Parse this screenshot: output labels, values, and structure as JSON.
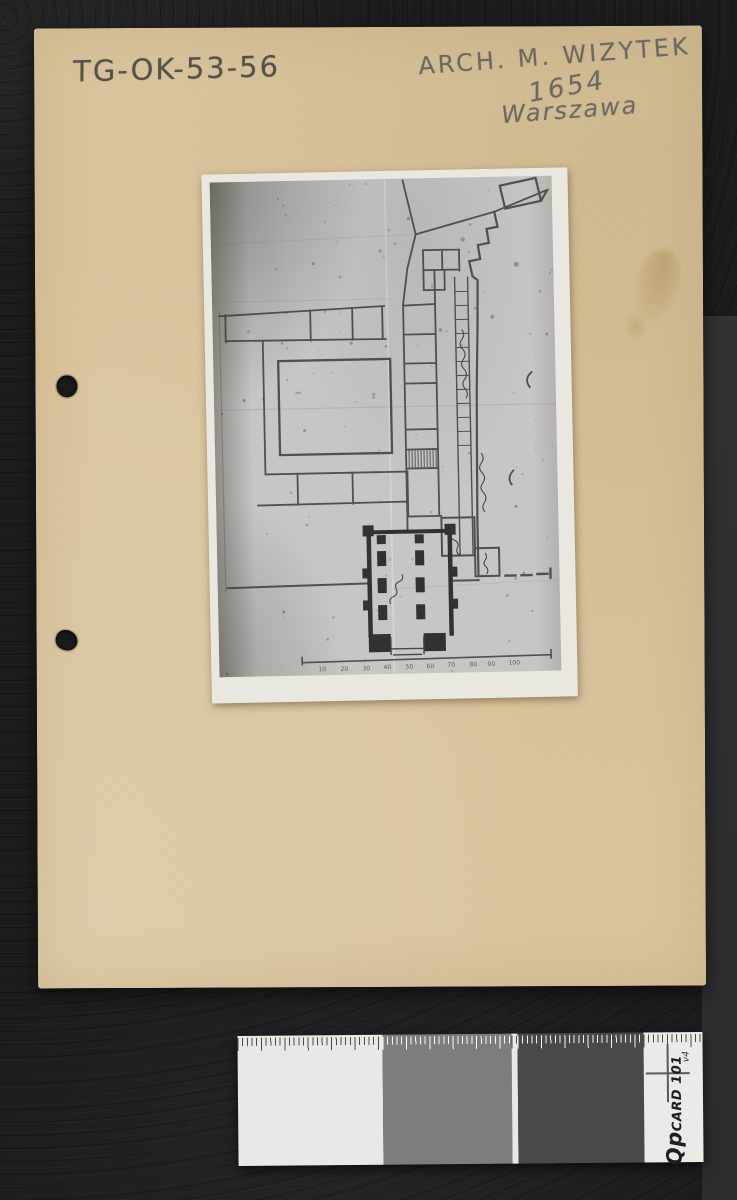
{
  "card": {
    "catalog_number": "TG-OK-53-56",
    "inscription_line1": "ARCH. M. WIZYTEK",
    "inscription_line2": "1654",
    "inscription_line3": "Warszawa"
  },
  "photo": {
    "scale_labels": [
      "10",
      "20",
      "30",
      "40",
      "50",
      "60",
      "70",
      "80",
      "90",
      "100"
    ]
  },
  "qpcard": {
    "brand_prefix": "Qp",
    "brand_rest": "CARD 101",
    "version": "v4",
    "patch_colors": {
      "white": "#e9e8e3",
      "gray": "#7d7d7b",
      "dark": "#4a4947"
    }
  },
  "colors": {
    "background_leather": "#1c1c1e",
    "background_band": "#302f31",
    "card_beige": "#d8c39c",
    "photo_paper": "#c7c6c1",
    "photo_border": "#eae7df",
    "pencil_gray": "#56524a",
    "plan_ink": "#44413a"
  }
}
